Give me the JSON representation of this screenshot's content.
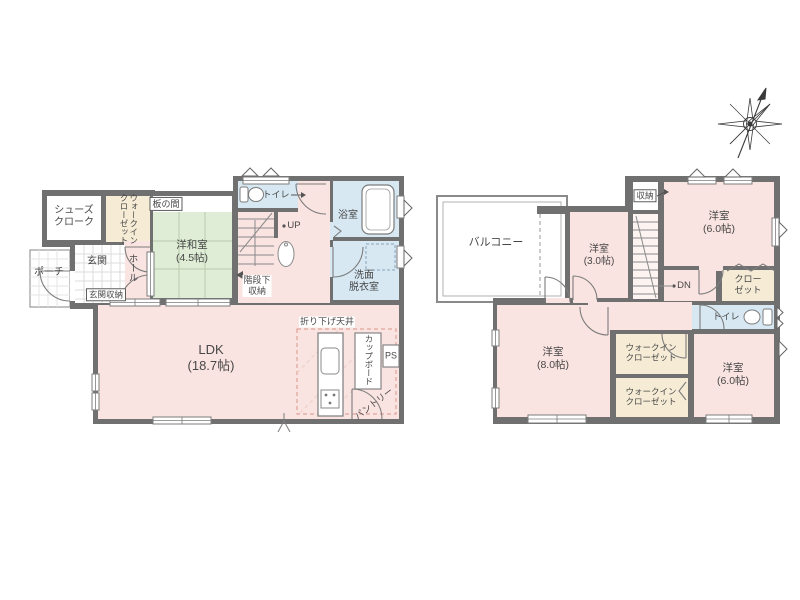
{
  "plan_type": "floorplan",
  "colors": {
    "wall": "#707070",
    "room_pink": "#fae4e1",
    "wet_blue": "#d7e8f3",
    "tatami_green": "#e0edd6",
    "closet_cream": "#f6ecd6",
    "label_text": "#474747"
  },
  "floor1": {
    "shoes_cloak": "シューズ\nクローク",
    "walk_in_closet": "ウォークイン\nクローゼット",
    "itanoma": "板の間",
    "washitsu": "洋和室\n(4.5帖)",
    "porch": "ポーチ",
    "genkan": "玄関",
    "genkan_storage": "玄関収納",
    "hall": "ホール",
    "toilet": "トイレ",
    "up": "UP",
    "under_stair_storage": "階段下\n収納",
    "bath": "浴室",
    "senmen": "洗面\n脱衣室",
    "ldk": "LDK\n(18.7帖)",
    "lowered_ceiling": "折り下げ天井",
    "cupboard": "カップボード",
    "ps": "PS",
    "pantry": "パントリー"
  },
  "floor2": {
    "balcony": "バルコニー",
    "room_3": "洋室\n(3.0帖)",
    "storage": "収納",
    "room_6_north": "洋室\n(6.0帖)",
    "dn": "DN",
    "closet": "クロー\nゼット",
    "toilet": "トイレ",
    "room_8": "洋室\n(8.0帖)",
    "wic_a": "ウォークイン\nクローゼット",
    "wic_b": "ウォークイン\nクローゼット",
    "room_6_south": "洋室\n(6.0帖)"
  }
}
